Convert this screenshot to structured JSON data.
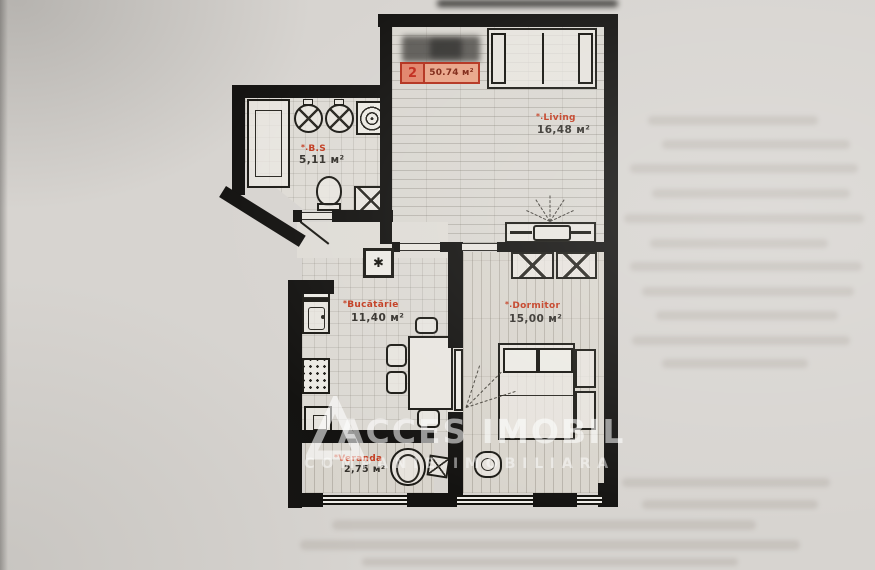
{
  "plan": {
    "unit_badge": {
      "number": "2",
      "total_area": "50.74 м²"
    },
    "vent_symbol": "✱",
    "rooms": {
      "living": {
        "marker": "*.",
        "name": "Living",
        "area": "16,48 м²"
      },
      "bathroom": {
        "marker": "*.",
        "name": "B.S",
        "area": "5,11 м²"
      },
      "kitchen": {
        "marker": "*",
        "name": "Bucătărie",
        "area": "11,40 м²"
      },
      "bedroom": {
        "marker": "*.",
        "name": "Dormitor",
        "area": "15,00 м²"
      },
      "veranda": {
        "marker": "*",
        "name": "Veranda",
        "area": "2,75 м²"
      }
    }
  },
  "watermark": {
    "title": "ACCES IMOBIL",
    "subtitle": "COMPANIE IMOBILIARA"
  },
  "colors": {
    "accent_red": "#c23a1e",
    "badge_fill": "#e9a488",
    "wall_black": "#141311",
    "paper": "#d7d4d0",
    "watermark_white": "rgba(255,255,255,0.55)"
  }
}
